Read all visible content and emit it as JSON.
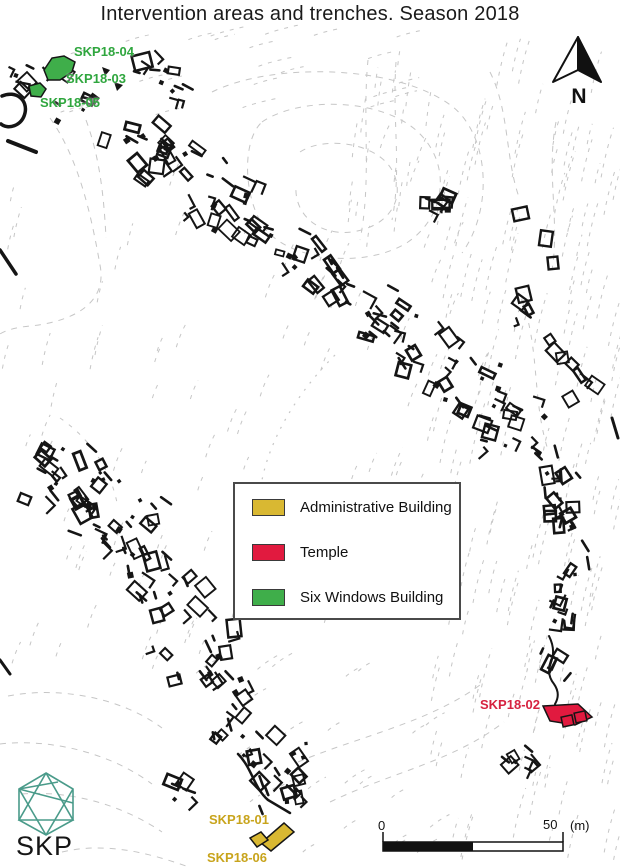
{
  "title": "Intervention areas and trenches. Season 2018",
  "north_label": "N",
  "logo": {
    "text": "SKP",
    "color": "#4a9b8a"
  },
  "trenches": [
    {
      "label": "SKP18-04",
      "category": "Six Windows Building",
      "color": "#2fa63e"
    },
    {
      "label": "SKP18-03",
      "category": "Six Windows Building",
      "color": "#2fa63e"
    },
    {
      "label": "SKP18-05",
      "category": "Six Windows Building",
      "color": "#2fa63e"
    },
    {
      "label": "SKP18-02",
      "category": "Temple",
      "color": "#d62240"
    },
    {
      "label": "SKP18-01",
      "category": "Administrative Building",
      "color": "#c8a41c"
    },
    {
      "label": "SKP18-06",
      "category": "Administrative Building",
      "color": "#c8a41c"
    }
  ],
  "legend": {
    "items": [
      {
        "label": "Administrative Building",
        "color": "#d9b832"
      },
      {
        "label": "Temple",
        "color": "#e11a3f"
      },
      {
        "label": "Six Windows Building",
        "color": "#3fae4a"
      }
    ]
  },
  "scale_bar": {
    "start": "0",
    "end": "50",
    "unit": "(m)"
  },
  "colors": {
    "contour_gray": "#c6c6c6",
    "ruin_black": "#151515",
    "admin_fill": "#d9b832",
    "temple_fill": "#e11a3f",
    "six_windows_fill": "#3fae4a"
  }
}
